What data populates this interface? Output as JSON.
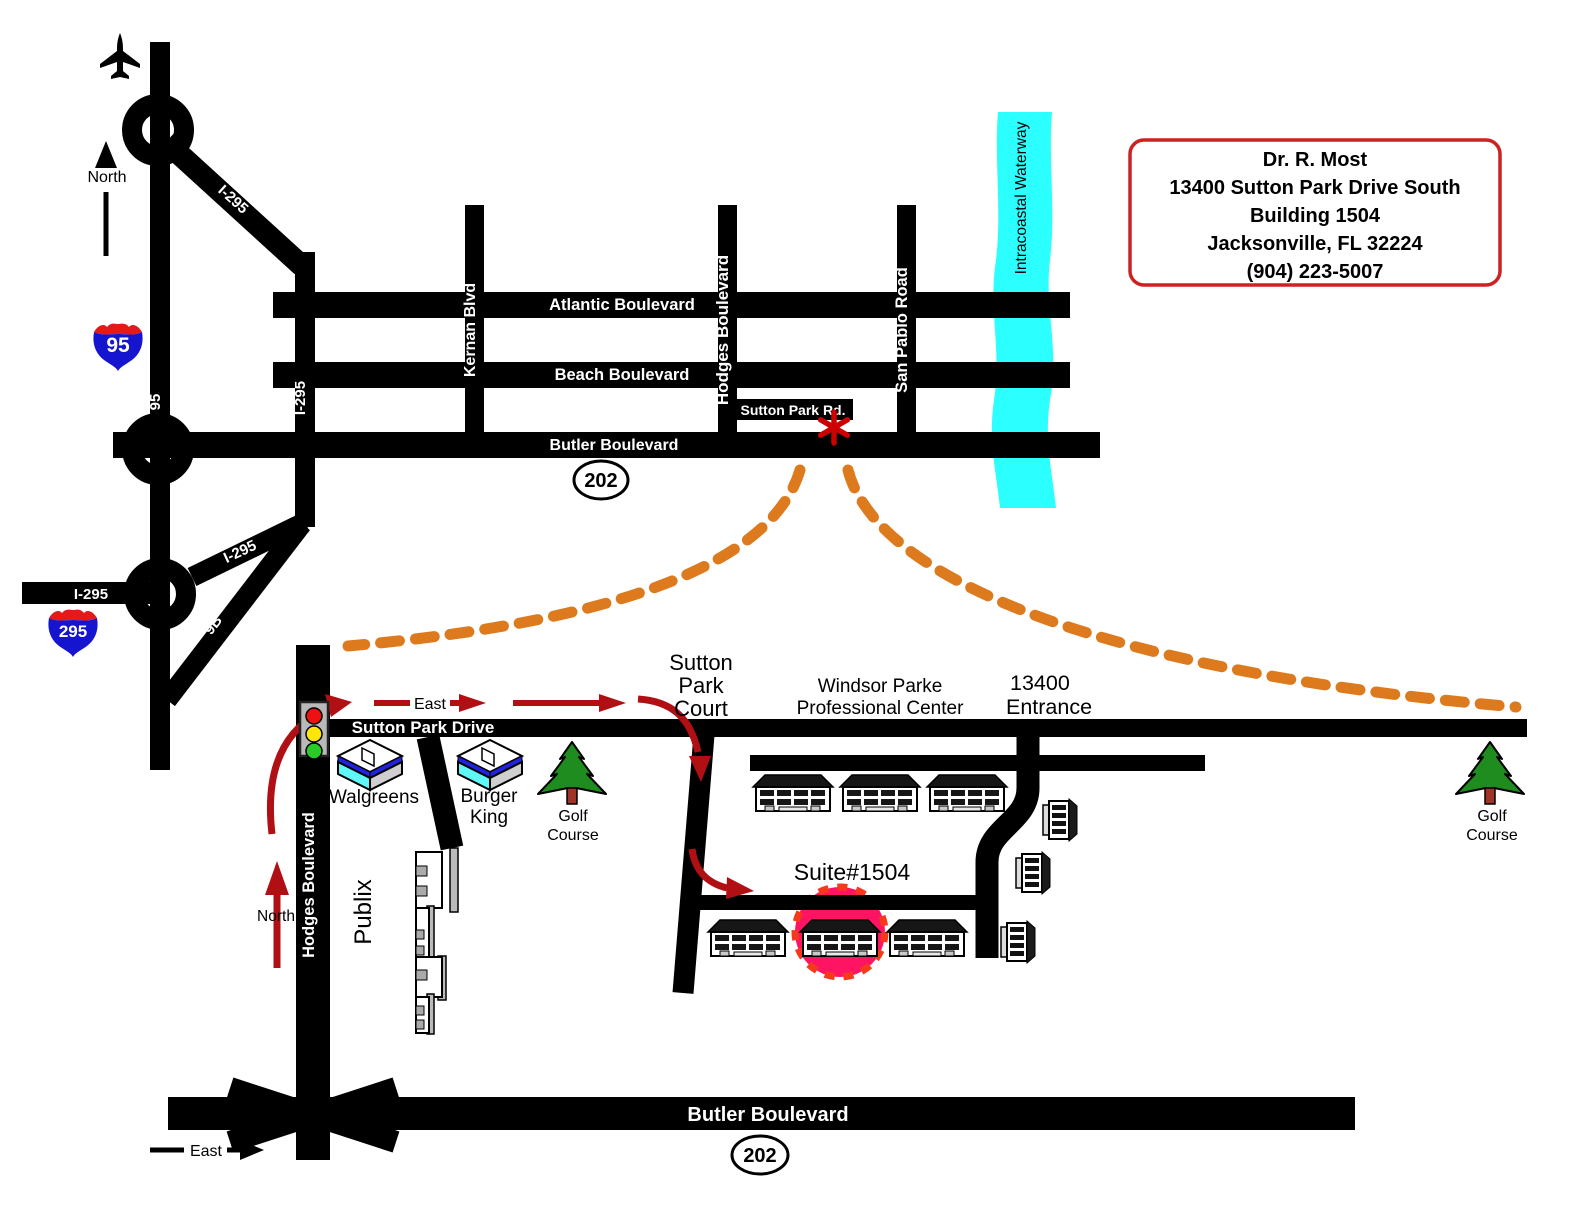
{
  "overview": {
    "north_label": "North",
    "roads": {
      "i95_shield": "95",
      "i295_shield": "295",
      "i95_road": "95",
      "i295_vertical": "I-295",
      "i295_diagonal_top": "I-295",
      "i295_west_stub": "I-295",
      "i295_diagonal_low": "I-295",
      "ramp_9b": "9B",
      "atlantic": "Atlantic Boulevard",
      "beach": "Beach Boulevard",
      "butler": "Butler Boulevard",
      "kernan": "Kernan Blvd",
      "hodges": "Hodges Boulevard",
      "san_pablo": "San Pablo Road",
      "sutton_park_rd": "Sutton Park Rd.",
      "route_202": "202"
    },
    "waterway_label": "Intracoastal Waterway"
  },
  "info_box": {
    "doctor": "Dr. R. Most",
    "address": "13400 Sutton Park Drive South",
    "building": "Building 1504",
    "city": "Jacksonville, FL  32224",
    "phone": "(904) 223-5007"
  },
  "detail": {
    "east_label_top": "East",
    "east_label_bottom": "East",
    "north_label": "North",
    "sutton_park_drive": "Sutton Park Drive",
    "hodges": "Hodges Boulevard",
    "butler": "Butler Boulevard",
    "route_202": "202",
    "court_line1": "Sutton",
    "court_line2": "Park",
    "court_line3": "Court",
    "windsor_line1": "Windsor Parke",
    "windsor_line2": "Professional Center",
    "entrance_line1": "13400",
    "entrance_line2": "Entrance",
    "suite": "Suite#1504",
    "walgreens": "Walgreens",
    "burger_line1": "Burger",
    "burger_line2": "King",
    "golf_line1": "Golf",
    "golf_line2": "Course",
    "publix": "Publix"
  },
  "colors": {
    "road": "#000000",
    "water": "#2bffff",
    "route_arrow": "#b01014",
    "highlight_fill": "#ff1464",
    "highlight_edge": "#f53a1c",
    "callout_dash": "#dd7a1e",
    "info_border": "#cc2222",
    "asterisk": "#cc0000",
    "shield_blue": "#1515d0",
    "shield_red": "#e31a1a",
    "tree_green": "#1f8c1f",
    "tree_trunk": "#a03327",
    "light_red": "#ee1111",
    "light_yellow": "#ffe60a",
    "light_green": "#28cc28"
  }
}
